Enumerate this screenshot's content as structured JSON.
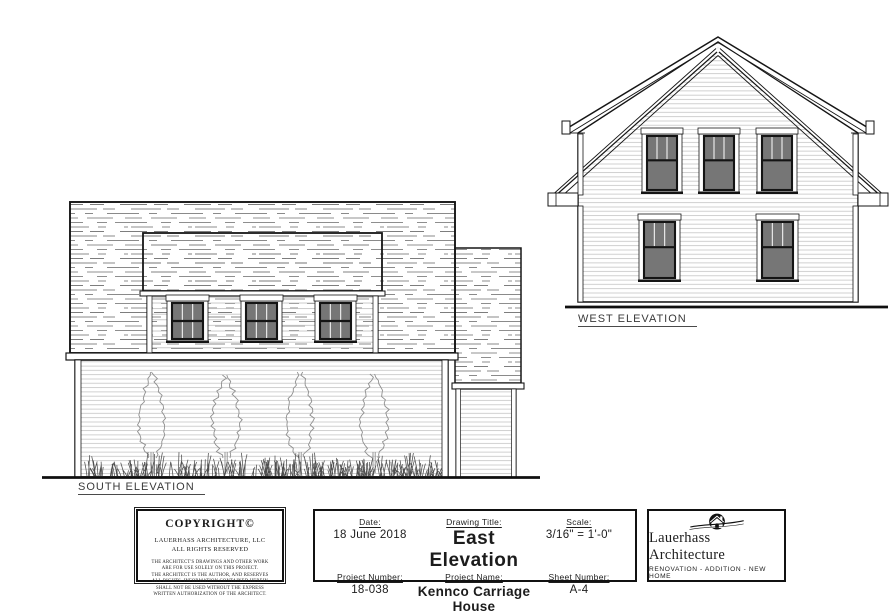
{
  "sheet": {
    "background": "#ffffff",
    "ink": "#1a1a1a"
  },
  "elevations": {
    "south": {
      "label": "SOUTH ELEVATION"
    },
    "west": {
      "label": "WEST ELEVATION"
    }
  },
  "title_block": {
    "copyright": {
      "title": "COPYRIGHT©",
      "owner_line1": "LAUERHASS ARCHITECTURE, LLC",
      "owner_line2": "ALL RIGHTS RESERVED",
      "notice": [
        "THE ARCHITECT'S DRAWINGS AND OTHER WORK",
        "ARE FOR USE SOLELY ON THIS PROJECT.",
        "THE ARCHITECT IS THE AUTHOR, AND RESERVES",
        "ALL RIGHTS.  INFORMATION CONTAINED HEREIN",
        "SHALL NOT BE USED WITHOUT THE EXPRESS",
        "WRITTEN AUTHORIZATION OF THE ARCHITECT."
      ]
    },
    "fields": {
      "date": {
        "label": "Date:",
        "value": "18 June 2018"
      },
      "drawing_title": {
        "label": "Drawing Title:",
        "value": "East Elevation"
      },
      "scale": {
        "label": "Scale:",
        "value": "3/16\" = 1'-0\""
      },
      "project_number": {
        "label": "Project Number:",
        "value": "18-038"
      },
      "project_name": {
        "label": "Project Name:",
        "value": "Kennco Carriage House"
      },
      "sheet_number": {
        "label": "Sheet Number:",
        "value": "A-4"
      }
    },
    "firm": {
      "name": "Lauerhass Architecture",
      "tagline": "RENOVATION - ADDITION - NEW HOME"
    }
  }
}
